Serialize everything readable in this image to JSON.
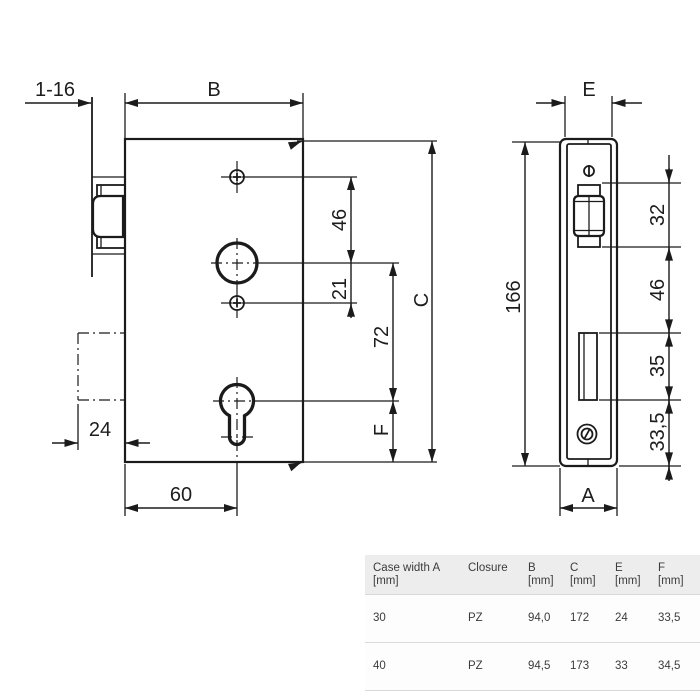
{
  "drawing": {
    "front_view": {
      "dim_nose": "1-16",
      "dim_depth": "B",
      "dim_screw_to_spindle": "46",
      "dim_spindle_to_screw": "21",
      "dim_spindle_to_cylinder": "72",
      "dim_height": "C",
      "dim_cylinder_to_bottom": "F",
      "dim_case_depth": "24",
      "dim_backset": "60"
    },
    "side_view": {
      "dim_faceplate_width": "E",
      "dim_plate_height": "166",
      "dim_latch_height": "32",
      "dim_latch_to_deadbolt": "46",
      "dim_deadbolt_height": "35",
      "dim_deadbolt_to_bottom": "33,5",
      "dim_case_width": "A"
    }
  },
  "table": {
    "headers": [
      [
        "Case width A",
        "[mm]"
      ],
      [
        "Closure",
        ""
      ],
      [
        "B",
        "[mm]"
      ],
      [
        "C",
        "[mm]"
      ],
      [
        "E",
        "[mm]"
      ],
      [
        "F",
        "[mm]"
      ]
    ],
    "rows": [
      [
        "30",
        "PZ",
        "94,0",
        "172",
        "24",
        "33,5"
      ],
      [
        "40",
        "PZ",
        "94,5",
        "173",
        "33",
        "34,5"
      ]
    ]
  },
  "colors": {
    "line": "#1b1b1b",
    "table_header_bg": "#ededed",
    "table_row_bg": "#fdfdfd",
    "table_border": "#d9d9d9",
    "table_text": "#3c3c3c"
  }
}
